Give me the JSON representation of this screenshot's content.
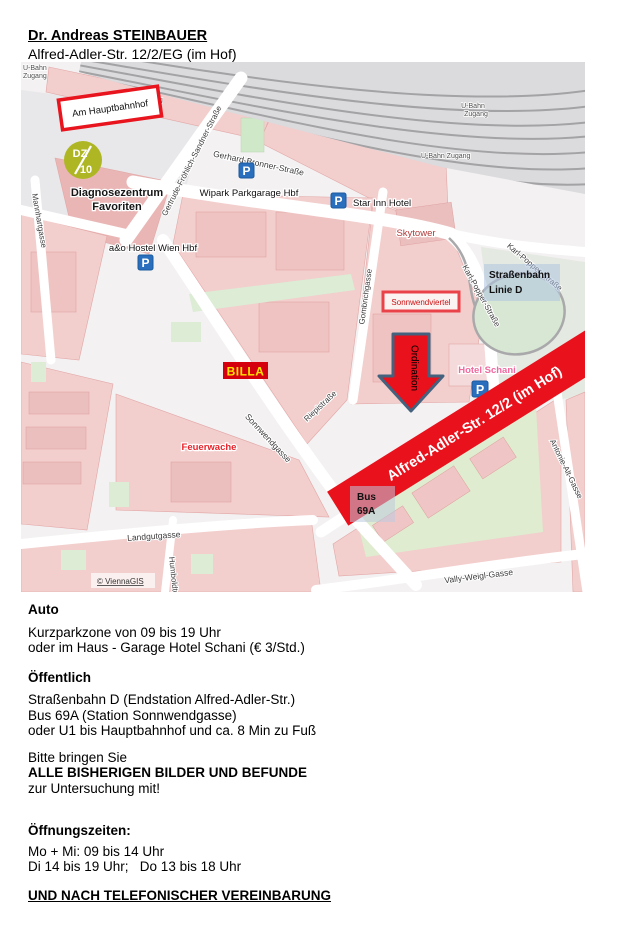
{
  "header": {
    "doctor_name": "Dr. Andreas STEINBAUER",
    "address": "Alfred-Adler-Str. 12/2/EG (im Hof)"
  },
  "map": {
    "attribution": "© ViennaGIS",
    "markers": {
      "parking_letter": "P",
      "am_hauptbahnhof": "Am Hauptbahnhof",
      "logo_dz": "DZ",
      "logo_10": "10",
      "diagnosezentrum_1": "Diagnosezentrum",
      "diagnosezentrum_2": "Favoriten",
      "wipark": "Wipark Parkgarage Hbf",
      "star_inn": "Star Inn Hotel",
      "hostel": "a&o Hostel Wien Hbf",
      "skytower": "Skytower",
      "sonnwendviertel": "Sonnwendviertel",
      "tram_1": "Straßenbahn",
      "tram_2": "Linie D",
      "ordination": "Ordination",
      "hotel_schani": "Hotel Schani",
      "billa": "BILLA",
      "feuerwache": "Feuerwache",
      "banner": "Alfred-Adler-Str. 12/2 (im Hof)",
      "bus_1": "Bus",
      "bus_2": "69A",
      "ubahn_1": "U-Bahn",
      "ubahn_2": "Zugang",
      "ubahn_single": "U-Bahn Zugang"
    },
    "streets": {
      "mannhartgasse": "Mannhartgasse",
      "gertrude": "Gertrude-Fröhlich-Sandner-Straße",
      "gerhard": "Gerhard-Bronner-Straße",
      "gombrich": "Gombrichgasse",
      "karl_popper": "Karl-Popper-Straße",
      "sonnwendgasse": "Sonnwendgasse",
      "riepistrasse": "Riepistraße",
      "antonie": "Antonie-Alt-Gasse",
      "landgutgasse": "Landgutgasse",
      "vally": "Vally-Weigl-Gasse",
      "humboldt": "Humboldtgasse"
    },
    "colors": {
      "highlight_red": "#e8111c",
      "parking_blue": "#2a6fbd",
      "logo_green": "#aeb723",
      "billa_red": "#d5000e",
      "billa_yellow": "#ffe400",
      "hotel_pink": "#f0699f"
    }
  },
  "info": {
    "auto_title": "Auto",
    "auto_line1": "Kurzparkzone von 09 bis 19 Uhr",
    "auto_line2": "oder im Haus - Garage Hotel Schani (€ 3/Std.)",
    "public_title": "Öffentlich",
    "public_line1": "Straßenbahn D (Endstation Alfred-Adler-Str.)",
    "public_line2": "Bus 69A (Station Sonnwendgasse)",
    "public_line3": "oder U1 bis Hauptbahnhof und ca. 8 Min zu Fuß",
    "bring_line1": "Bitte bringen Sie",
    "bring_line2": "ALLE BISHERIGEN BILDER UND BEFUNDE",
    "bring_line3": "zur Untersuchung mit!",
    "hours_title": "Öffnungszeiten:",
    "hours_line1": "Mo + Mi: 09 bis 14 Uhr",
    "hours_line2": "Di 14 bis 19 Uhr;   Do 13 bis 18 Uhr",
    "footer": "UND NACH TELEFONISCHER VEREINBARUNG"
  }
}
